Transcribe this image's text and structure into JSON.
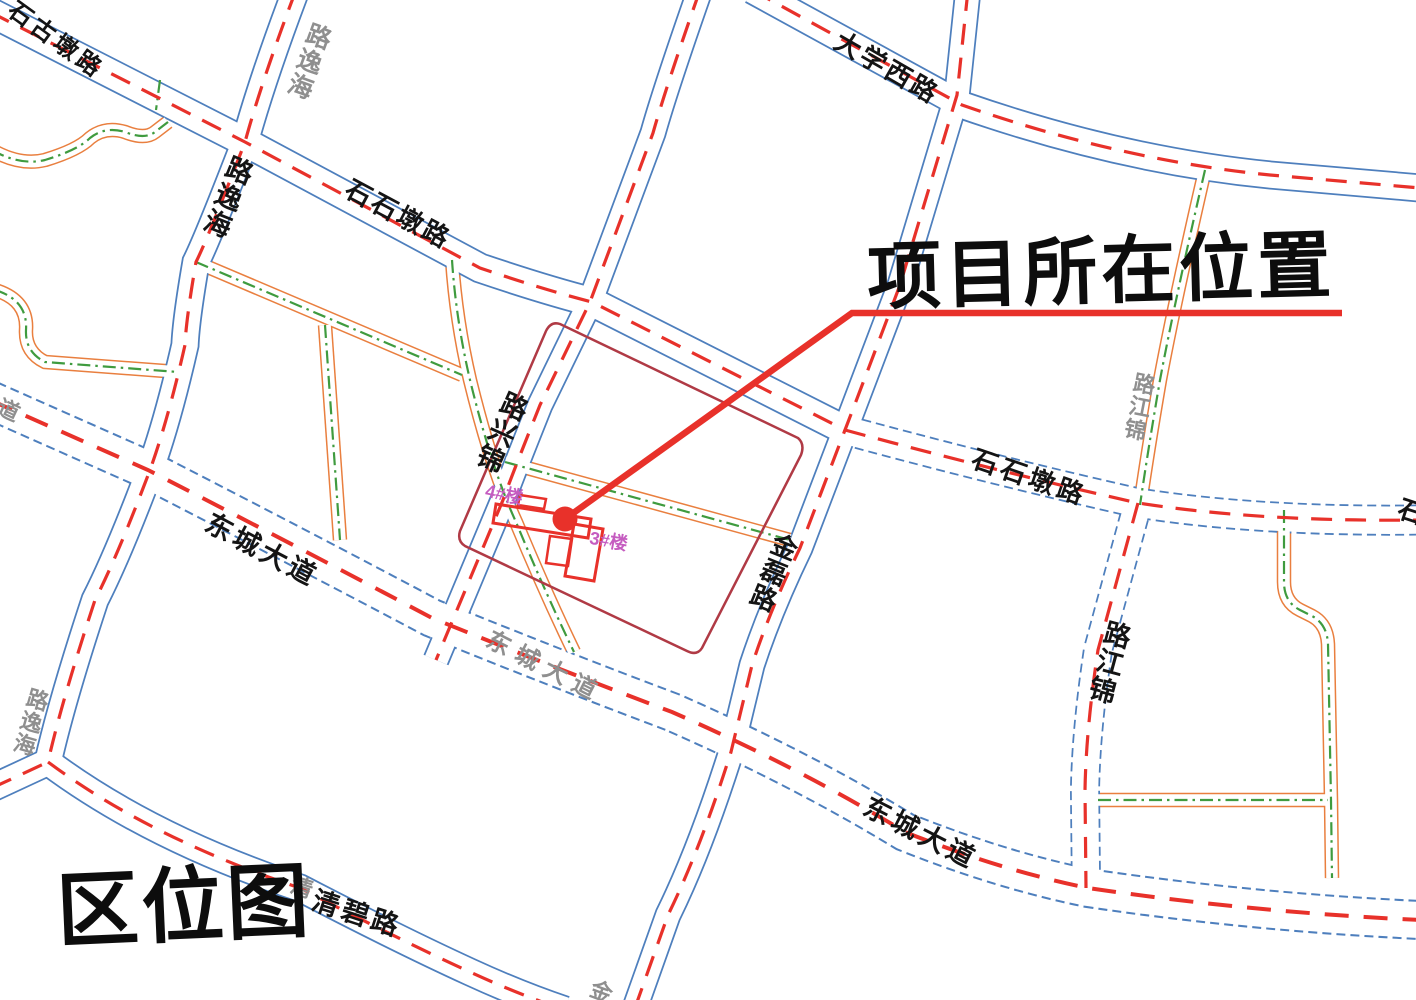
{
  "map_title": "区位图",
  "annotation": "项目所在位置",
  "palette": {
    "road_edge_blue": "#4e7fbd",
    "road_center_red": "#e8312a",
    "minor_edge_orange": "#e97f3f",
    "minor_center_green": "#3f9b3f",
    "site_boundary": "#b03a45",
    "building_red": "#e8312a",
    "label_black": "#141414",
    "label_gray": "#8f8f8f",
    "label_magenta": "#c55cc0"
  },
  "building_labels": [
    {
      "name": "building-4",
      "text": "4#楼",
      "x": 487,
      "y": 484,
      "rot": 12,
      "size": 18
    },
    {
      "name": "building-3",
      "text": "3#楼",
      "x": 591,
      "y": 531,
      "rot": 10,
      "size": 18
    }
  ],
  "road_labels": [
    {
      "name": "石古墩路",
      "display": "石古墩路",
      "vertical": false,
      "x": 16,
      "y": 0,
      "rot": 36,
      "size": 24,
      "ls": 4,
      "color": "label_black"
    },
    {
      "name": "海逸路",
      "display": "路逸海",
      "vertical": true,
      "x": 322,
      "y": 28,
      "rot": 20,
      "size": 25,
      "ls": 0,
      "color": "label_gray"
    },
    {
      "name": "海逸路",
      "display": "路逸海",
      "vertical": true,
      "x": 243,
      "y": 162,
      "rot": 22,
      "size": 27,
      "ls": 0,
      "color": "label_black"
    },
    {
      "name": "石石墩路",
      "display": "石石墩路",
      "vertical": false,
      "x": 352,
      "y": 178,
      "rot": 28,
      "size": 26,
      "ls": 3,
      "color": "label_black"
    },
    {
      "name": "大学西路",
      "display": "大学西路",
      "vertical": false,
      "x": 842,
      "y": 30,
      "rot": 30,
      "size": 26,
      "ls": 3,
      "color": "label_black"
    },
    {
      "name": "锦兴路",
      "display": "路兴锦",
      "vertical": true,
      "x": 518,
      "y": 398,
      "rot": 24,
      "size": 27,
      "ls": 0,
      "color": "label_black"
    },
    {
      "name": "金磊路",
      "display": "金磊路",
      "vertical": true,
      "x": 788,
      "y": 538,
      "rot": 22,
      "size": 26,
      "ls": 0,
      "color": "label_black"
    },
    {
      "name": "石石墩路",
      "display": "石石墩路",
      "vertical": false,
      "x": 976,
      "y": 448,
      "rot": 19,
      "size": 26,
      "ls": 4,
      "color": "label_black"
    },
    {
      "name": "东城大道",
      "display": "东城大道",
      "vertical": false,
      "x": 212,
      "y": 512,
      "rot": 28,
      "size": 27,
      "ls": 4,
      "color": "label_black"
    },
    {
      "name": "东城大道",
      "display": "东城大道",
      "vertical": false,
      "x": 492,
      "y": 630,
      "rot": 27,
      "size": 24,
      "ls": 8,
      "color": "label_gray"
    },
    {
      "name": "东城大道",
      "display": "东城大道",
      "vertical": false,
      "x": 870,
      "y": 796,
      "rot": 27,
      "size": 27,
      "ls": 4,
      "color": "label_black"
    },
    {
      "name": "锦江路",
      "display": "路江锦",
      "vertical": true,
      "x": 1120,
      "y": 626,
      "rot": 15,
      "size": 27,
      "ls": 0,
      "color": "label_black"
    },
    {
      "name": "锦江路",
      "display": "路江锦",
      "vertical": true,
      "x": 1146,
      "y": 376,
      "rot": 11,
      "size": 22,
      "ls": 0,
      "color": "label_gray"
    },
    {
      "name": "清碧路",
      "display": "清碧路",
      "vertical": false,
      "x": 316,
      "y": 890,
      "rot": 18,
      "size": 27,
      "ls": 4,
      "color": "label_black"
    },
    {
      "name": "清碧路",
      "display": "清",
      "vertical": false,
      "x": 294,
      "y": 876,
      "rot": 18,
      "size": 22,
      "ls": 0,
      "color": "label_gray"
    },
    {
      "name": "东城大道",
      "display": "道",
      "vertical": false,
      "x": 2,
      "y": 398,
      "rot": 25,
      "size": 22,
      "ls": 0,
      "color": "label_gray"
    },
    {
      "name": "海逸路",
      "display": "路逸海",
      "vertical": true,
      "x": 40,
      "y": 692,
      "rot": 16,
      "size": 22,
      "ls": 0,
      "color": "label_gray"
    },
    {
      "name": "石石墩路",
      "display": "石",
      "vertical": false,
      "x": 1402,
      "y": 498,
      "rot": 18,
      "size": 26,
      "ls": 0,
      "color": "label_black"
    },
    {
      "name": "金磊路",
      "display": "金",
      "vertical": false,
      "x": 594,
      "y": 980,
      "rot": 20,
      "size": 22,
      "ls": 0,
      "color": "label_gray"
    }
  ]
}
